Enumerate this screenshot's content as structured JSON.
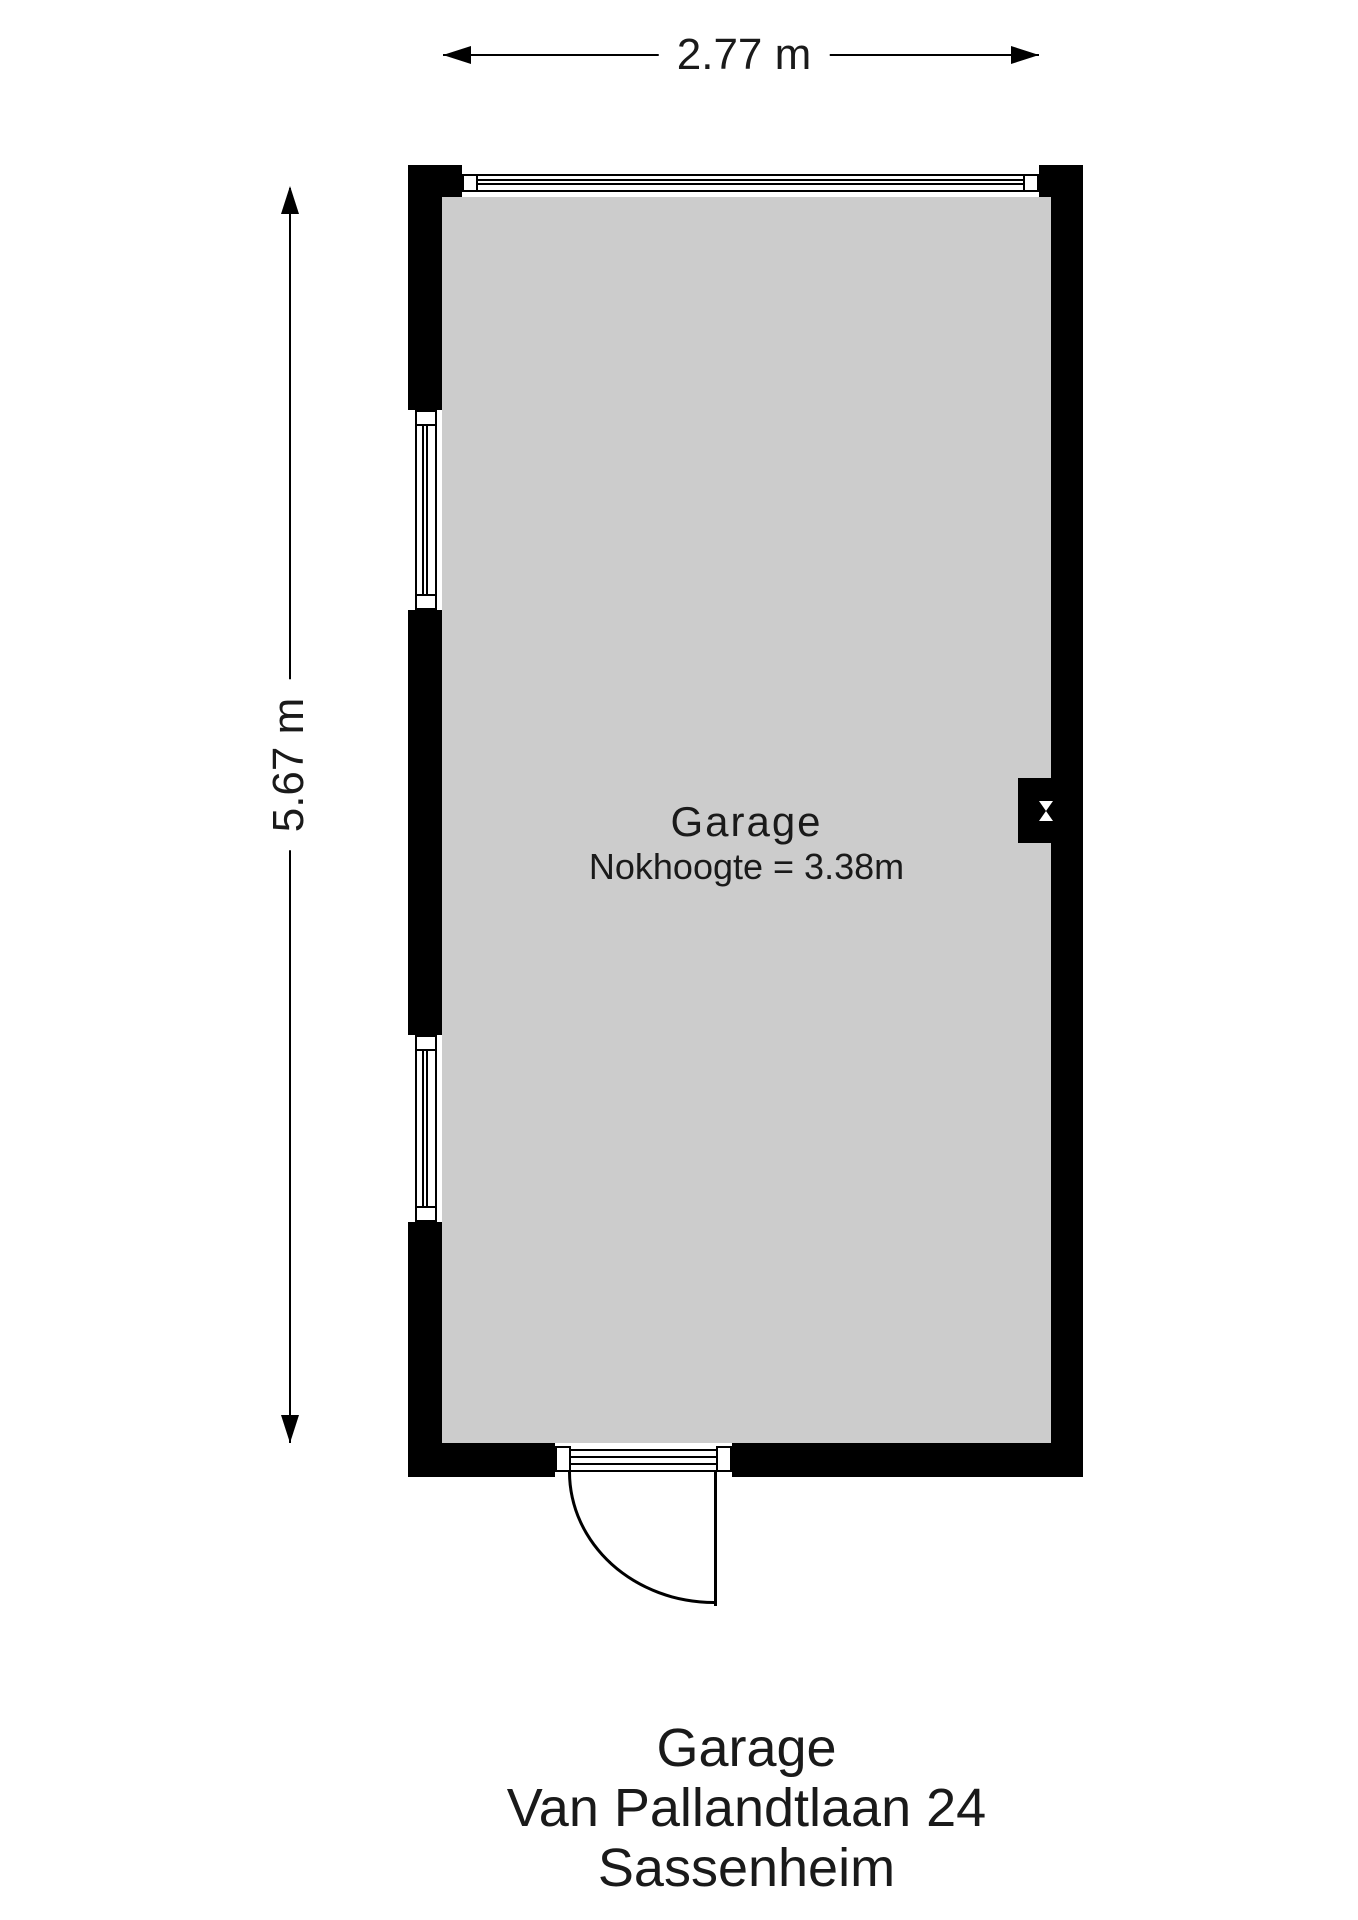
{
  "dimensions": {
    "width_label": "2.77 m",
    "height_label": "5.67 m"
  },
  "room": {
    "name": "Garage",
    "ridge_height_note": "Nokhoogte = 3.38m"
  },
  "caption": {
    "building": "Garage",
    "street": "Van Pallandtlaan 24",
    "city": "Sassenheim"
  },
  "icons": {
    "flue": "flue-icon (white bowtie / hourglass on black wall block)",
    "door": "quarter-circle swing arc, hinge right",
    "window": "double-line glазing symbol"
  },
  "colors": {
    "wall": "#000000",
    "floor": "#cccccc",
    "background": "#ffffff",
    "lines_text": "#1a1a1a"
  }
}
